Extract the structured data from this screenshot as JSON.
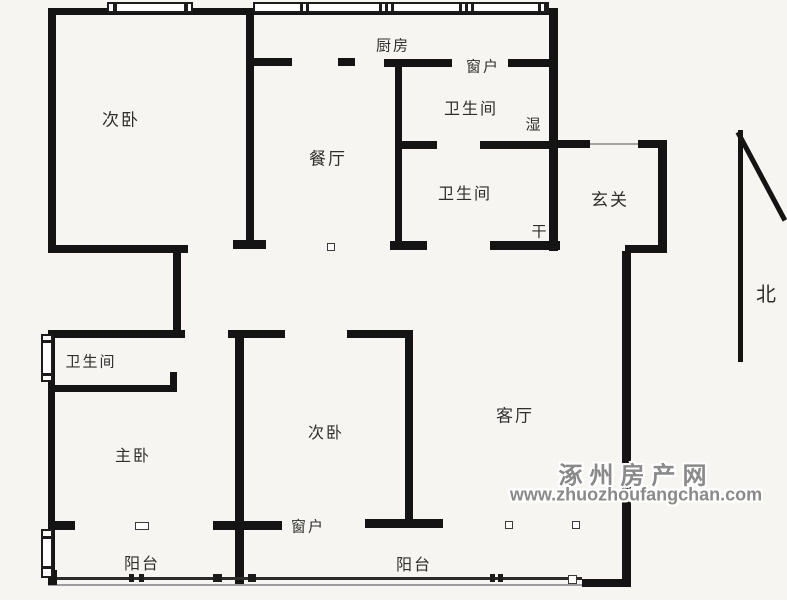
{
  "plan": {
    "colors": {
      "background": "#f6f5f2",
      "wall": "#141414",
      "label": "#2e2e2e",
      "watermark": "#8a8a8a"
    },
    "rooms": {
      "bedroom_top_left": "次卧",
      "kitchen": "厨房",
      "dining": "餐厅",
      "bathroom_upper": "卫生间",
      "bathroom_lower": "卫生间",
      "wet_zone": "湿",
      "dry_zone": "干",
      "foyer": "玄关",
      "bathroom_master": "卫生间",
      "master_bedroom": "主卧",
      "bedroom_middle": "次卧",
      "living_room": "客厅",
      "balcony_left": "阳台",
      "balcony_right": "阳台"
    },
    "annotations": {
      "window_top": "窗户",
      "window_bottom": "窗户",
      "north": "北"
    },
    "watermark": {
      "site_name": "涿州房产网",
      "site_url": "www.zhuozhoufangchan.com"
    }
  }
}
